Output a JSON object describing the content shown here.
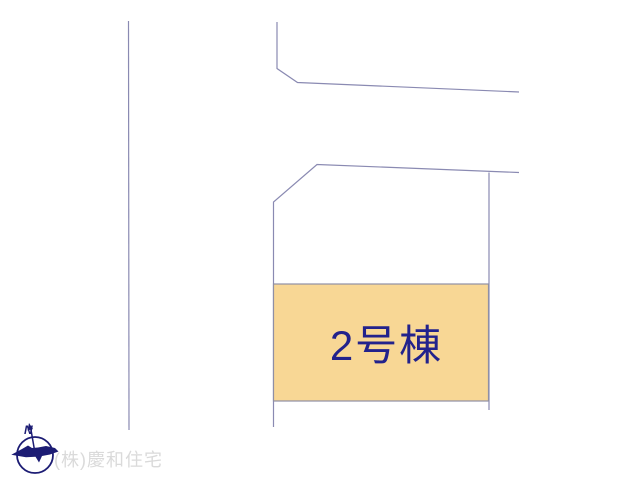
{
  "plan": {
    "lot": {
      "label": "2号棟"
    },
    "company": {
      "watermark": "(株)慶和住宅"
    },
    "compass": {
      "north_label": "N"
    },
    "colors": {
      "background": "#FFFFFF",
      "boundary_line": "#8A8AB2",
      "lot_fill": "#F8D795",
      "lot_border": "#8F8FA5",
      "lot_label_text": "#22228C",
      "compass": "#1C1C74",
      "watermark_text": "#DADADA"
    }
  }
}
